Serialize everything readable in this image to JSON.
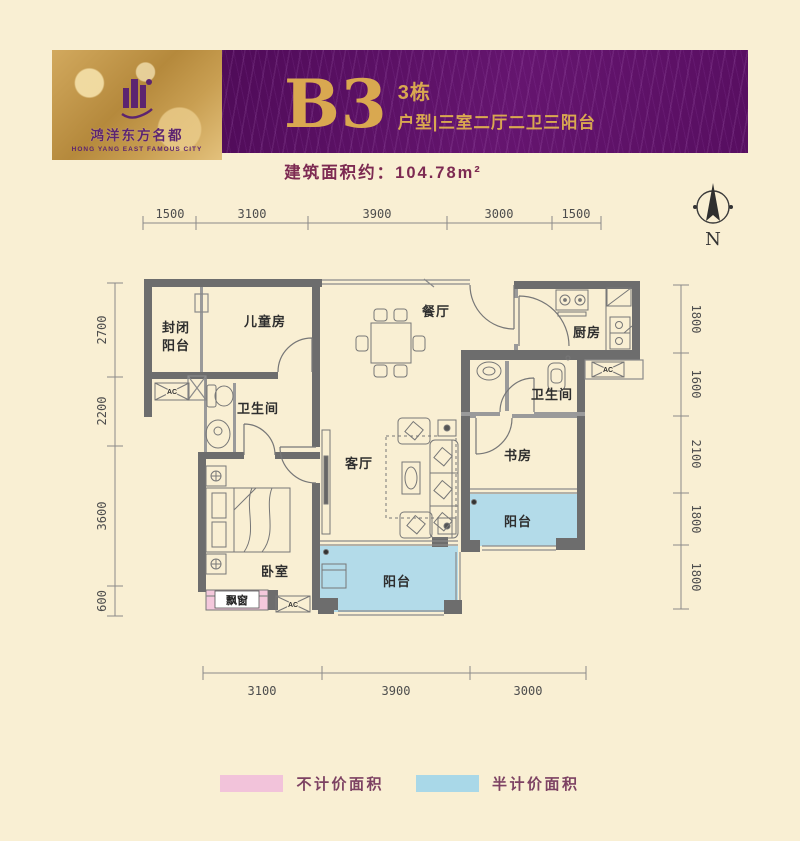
{
  "header": {
    "logo_cn": "鸿洋东方名都",
    "logo_en": "HONG YANG EAST FAMOUS CITY",
    "unit_code": "B3",
    "building": "3栋",
    "unit_desc": "户型|三室二厅二卫三阳台"
  },
  "area_note": "建筑面积约：104.78m²",
  "compass_label": "N",
  "dimensions": {
    "top": [
      "1500",
      "3100",
      "3900",
      "3000",
      "1500"
    ],
    "left": [
      "2700",
      "2200",
      "3600",
      "600"
    ],
    "right": [
      "1800",
      "1600",
      "2100",
      "1800",
      "1800"
    ],
    "bottom": [
      "3100",
      "3900",
      "3000"
    ]
  },
  "rooms": {
    "closed_balcony_l1": "封闭",
    "closed_balcony_l2": "阳台",
    "children_room": "儿童房",
    "dining": "餐厅",
    "kitchen": "厨房",
    "bath1": "卫生间",
    "bath2": "卫生间",
    "living": "客厅",
    "study": "书房",
    "balcony_right": "阳台",
    "balcony_bottom": "阳台",
    "bedroom": "卧室",
    "bay_window": "飘窗",
    "ac": "AC"
  },
  "legend": [
    {
      "label": "不计价面积",
      "color": "#f2c3da"
    },
    {
      "label": "半计价面积",
      "color": "#a9d8e8"
    }
  ],
  "colors": {
    "banner_purple": "#5a0e63",
    "banner_gold": "#c59a4e",
    "accent_gold": "#d9a850",
    "maroon": "#7d2a52",
    "wall": "#6d6d6d",
    "balcony_blue": "#b3dbe9",
    "bay_pink": "#f4c8dc",
    "background": "#f9efd3"
  }
}
